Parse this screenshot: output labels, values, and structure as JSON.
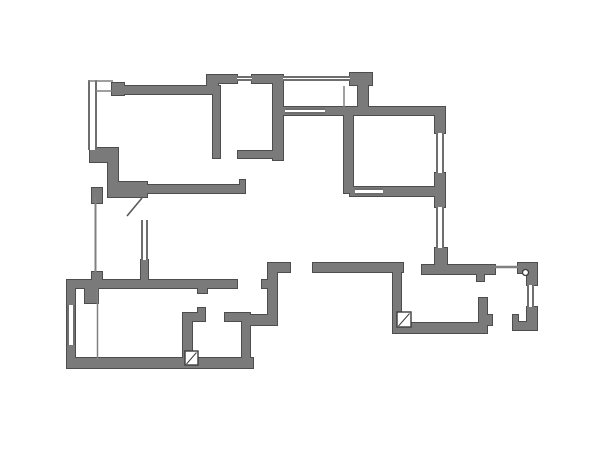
{
  "floor_plan": {
    "canvas": {
      "width": 600,
      "height": 450,
      "background": "#ffffff"
    },
    "style": {
      "wall_fill": "#7a7a7a",
      "wall_outline": "#4d4d4d",
      "window_line": "#6e6e6e",
      "thin_line": "#808080",
      "door_line": "#5a5a5a",
      "symbol_line": "#3c3c3c",
      "symbol_fill": "#ffffff"
    },
    "walls": [
      [
        112,
        83,
        12,
        12
      ],
      [
        112,
        86,
        101,
        8
      ],
      [
        207,
        75,
        11,
        19
      ],
      [
        207,
        75,
        30,
        8
      ],
      [
        252,
        75,
        31,
        8
      ],
      [
        350,
        73,
        22,
        12
      ],
      [
        358,
        85,
        10,
        22
      ],
      [
        273,
        107,
        172,
        8
      ],
      [
        213,
        86,
        7,
        72
      ],
      [
        273,
        75,
        10,
        85
      ],
      [
        238,
        151,
        35,
        7
      ],
      [
        344,
        115,
        9,
        78
      ],
      [
        350,
        187,
        95,
        9
      ],
      [
        435,
        107,
        10,
        26
      ],
      [
        435,
        173,
        10,
        34
      ],
      [
        435,
        248,
        12,
        17
      ],
      [
        108,
        148,
        10,
        49
      ],
      [
        90,
        148,
        23,
        14
      ],
      [
        113,
        182,
        34,
        15
      ],
      [
        147,
        185,
        98,
        8
      ],
      [
        240,
        180,
        5,
        5
      ],
      [
        92,
        188,
        10,
        15
      ],
      [
        92,
        272,
        10,
        13
      ],
      [
        141,
        260,
        7,
        22
      ],
      [
        67,
        280,
        170,
        8
      ],
      [
        198,
        288,
        9,
        5
      ],
      [
        85,
        288,
        13,
        15
      ],
      [
        67,
        280,
        8,
        88
      ],
      [
        67,
        358,
        186,
        10
      ],
      [
        183,
        315,
        9,
        48
      ],
      [
        183,
        313,
        22,
        8
      ],
      [
        198,
        308,
        7,
        5
      ],
      [
        225,
        313,
        25,
        8
      ],
      [
        242,
        313,
        8,
        50
      ],
      [
        268,
        263,
        9,
        54
      ],
      [
        277,
        263,
        13,
        9
      ],
      [
        262,
        280,
        6,
        8
      ],
      [
        248,
        315,
        29,
        10
      ],
      [
        313,
        263,
        90,
        9
      ],
      [
        393,
        272,
        8,
        61
      ],
      [
        393,
        323,
        94,
        10
      ],
      [
        479,
        298,
        8,
        27
      ],
      [
        487,
        315,
        5,
        10
      ],
      [
        422,
        265,
        73,
        9
      ],
      [
        477,
        274,
        7,
        7
      ],
      [
        518,
        263,
        19,
        10
      ],
      [
        527,
        273,
        10,
        12
      ],
      [
        527,
        307,
        10,
        15
      ],
      [
        513,
        322,
        24,
        8
      ],
      [
        513,
        315,
        5,
        7
      ]
    ],
    "windows": [
      {
        "x": 237,
        "y": 75.5,
        "w": 15,
        "h": 5,
        "o": "h"
      },
      {
        "x": 283,
        "y": 75.5,
        "w": 67,
        "h": 5,
        "o": "h"
      },
      {
        "x": 285,
        "y": 108,
        "w": 40,
        "h": 6,
        "o": "h"
      },
      {
        "x": 436,
        "y": 133,
        "w": 8,
        "h": 40,
        "o": "v"
      },
      {
        "x": 436,
        "y": 207,
        "w": 8,
        "h": 41,
        "o": "v"
      },
      {
        "x": 355,
        "y": 188,
        "w": 28,
        "h": 7,
        "o": "h"
      },
      {
        "x": 141,
        "y": 220,
        "w": 7,
        "h": 40,
        "o": "v"
      },
      {
        "x": 67,
        "y": 305,
        "w": 8,
        "h": 40,
        "o": "v"
      },
      {
        "x": 527,
        "y": 285,
        "w": 7,
        "h": 22,
        "o": "v"
      },
      {
        "x": 88,
        "y": 80,
        "w": 9,
        "h": 70,
        "o": "v"
      }
    ],
    "thin_lines": [
      {
        "x1": 88,
        "y1": 81,
        "x2": 113,
        "y2": 81,
        "w": 1.5
      },
      {
        "x1": 96,
        "y1": 91,
        "x2": 113,
        "y2": 91,
        "w": 1.5
      },
      {
        "x1": 95.5,
        "y1": 197,
        "x2": 95.5,
        "y2": 272,
        "w": 2
      },
      {
        "x1": 97.5,
        "y1": 288,
        "x2": 97.5,
        "y2": 360,
        "w": 1.5
      },
      {
        "x1": 344,
        "y1": 86,
        "x2": 344,
        "y2": 107,
        "w": 1.5
      },
      {
        "x1": 495,
        "y1": 267,
        "x2": 518,
        "y2": 267,
        "w": 2.5
      }
    ],
    "door_leaves": [
      {
        "x1": 127,
        "y1": 216,
        "x2": 142,
        "y2": 198
      }
    ],
    "shaft_symbols": [
      {
        "x": 397,
        "y": 312,
        "w": 14,
        "h": 15,
        "dx1": 398.5,
        "dy1": 326,
        "dx2": 409.5,
        "dy2": 313.5
      },
      {
        "x": 185,
        "y": 351,
        "w": 13,
        "h": 14,
        "dx1": 186.5,
        "dy1": 364,
        "dx2": 196.5,
        "dy2": 352.5
      }
    ],
    "circles": [
      {
        "cx": 525.5,
        "cy": 272.5,
        "r": 3
      }
    ]
  }
}
